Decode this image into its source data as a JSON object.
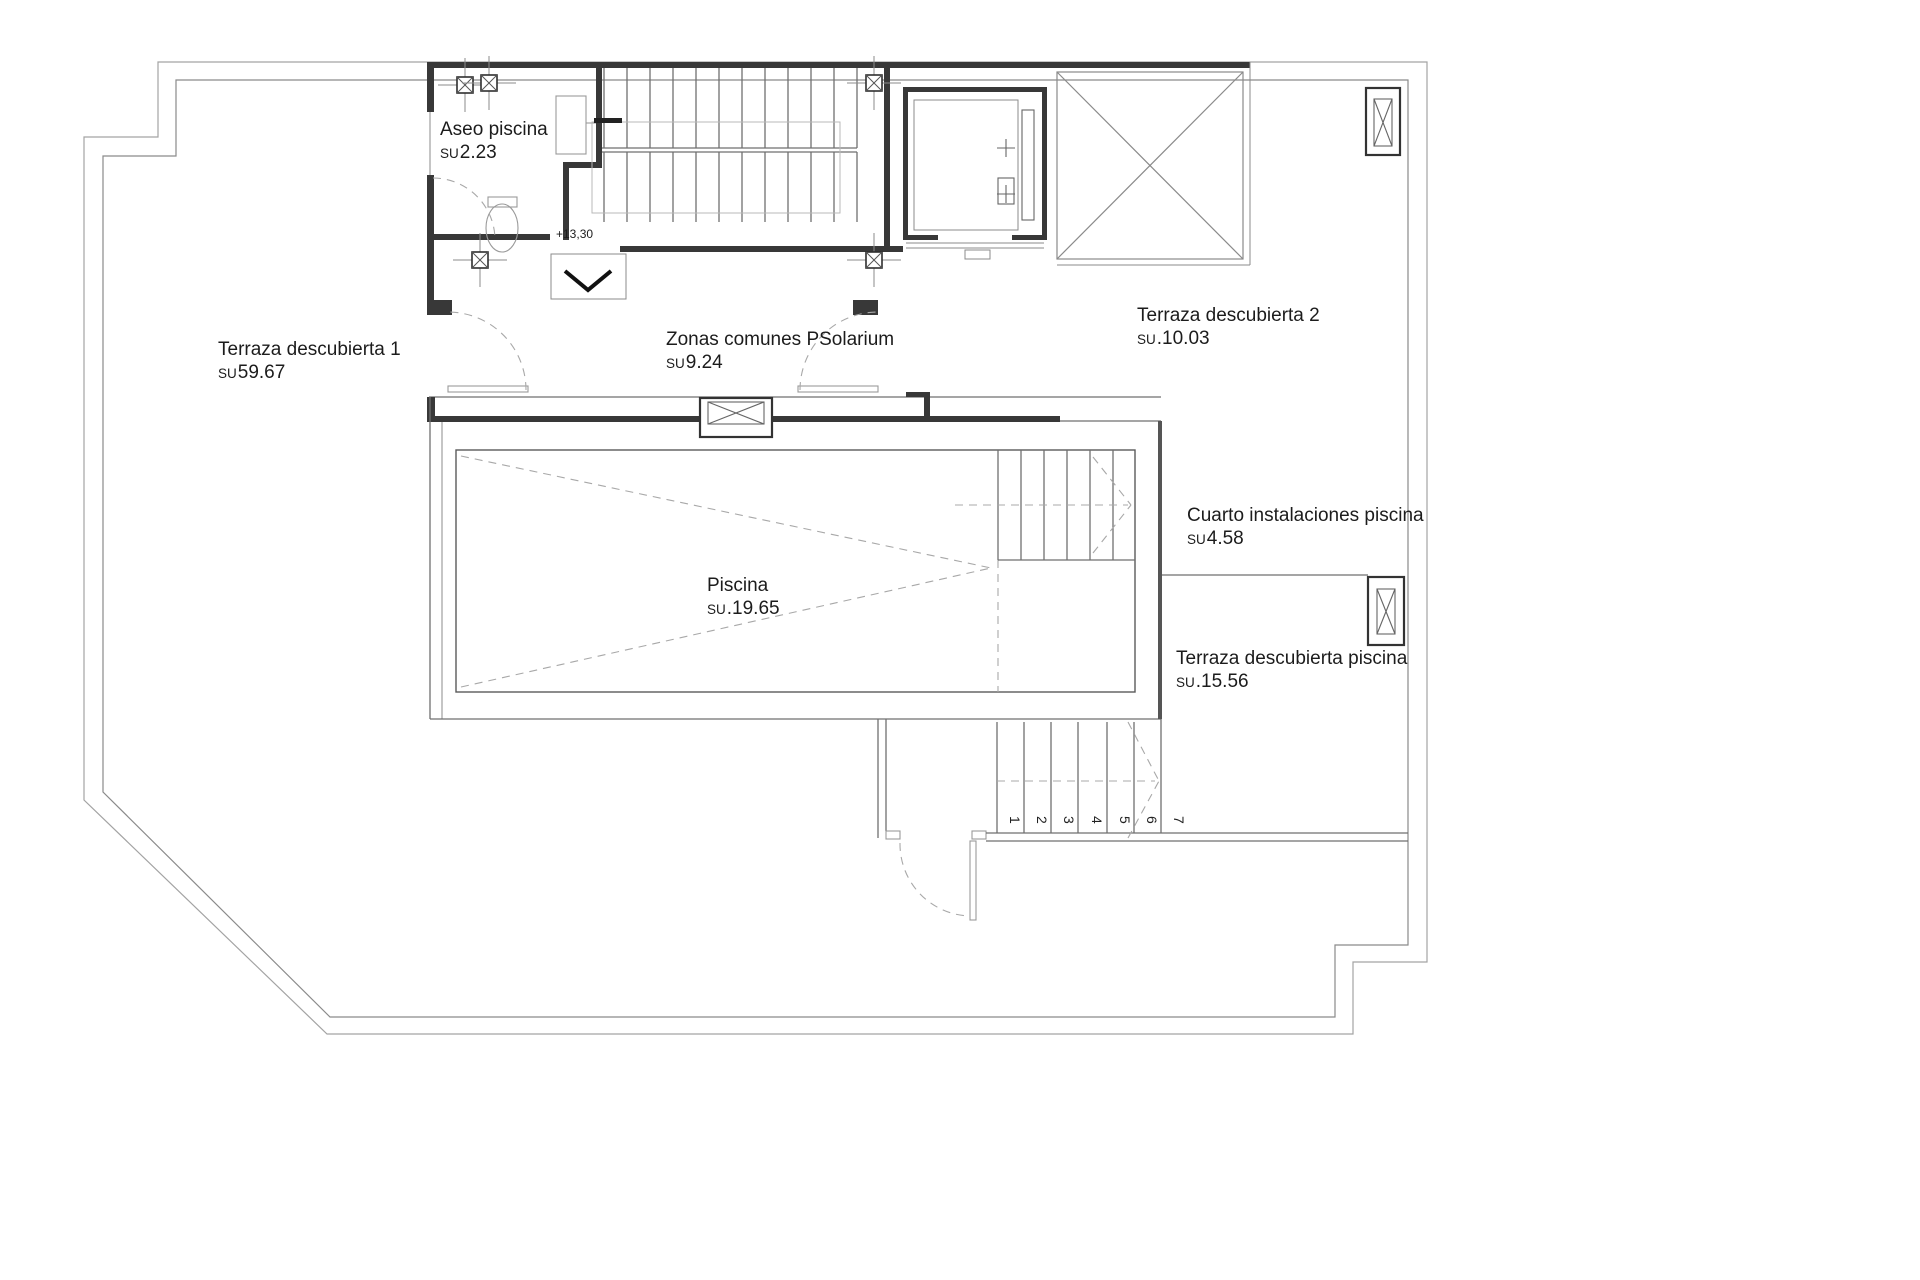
{
  "document": {
    "type": "architectural-floor-plan",
    "level_marker": "+13,30"
  },
  "rooms": [
    {
      "id": "aseo-piscina",
      "name": "Aseo piscina",
      "su": "SU",
      "area": "2.23"
    },
    {
      "id": "terraza-descubierta-1",
      "name": "Terraza descubierta 1",
      "su": "SU",
      "area": "59.67"
    },
    {
      "id": "zonas-comunes-solarium",
      "name": "Zonas comunes PSolarium",
      "su": "SU",
      "area": "9.24"
    },
    {
      "id": "terraza-descubierta-2",
      "name": "Terraza descubierta 2",
      "su": "SU",
      "area": ".10.03"
    },
    {
      "id": "cuarto-instalaciones-piscina",
      "name": "Cuarto instalaciones piscina",
      "su": "SU",
      "area": "4.58"
    },
    {
      "id": "piscina",
      "name": "Piscina",
      "su": "SU",
      "area": ".19.65"
    },
    {
      "id": "terraza-descubierta-piscina",
      "name": "Terraza descubierta piscina",
      "su": "SU",
      "area": ".15.56"
    }
  ],
  "stairs": {
    "lower_flight_numbers": [
      "1",
      "2",
      "3",
      "4",
      "5",
      "6",
      "7"
    ]
  },
  "colors": {
    "wall": "#383838",
    "thin_line": "#6f6f6f",
    "light_line": "#b9b9b9",
    "dashed_line": "#a8a8a8",
    "boundary": "#a3a3a3",
    "text": "#1c1c1c",
    "background": "#ffffff"
  }
}
